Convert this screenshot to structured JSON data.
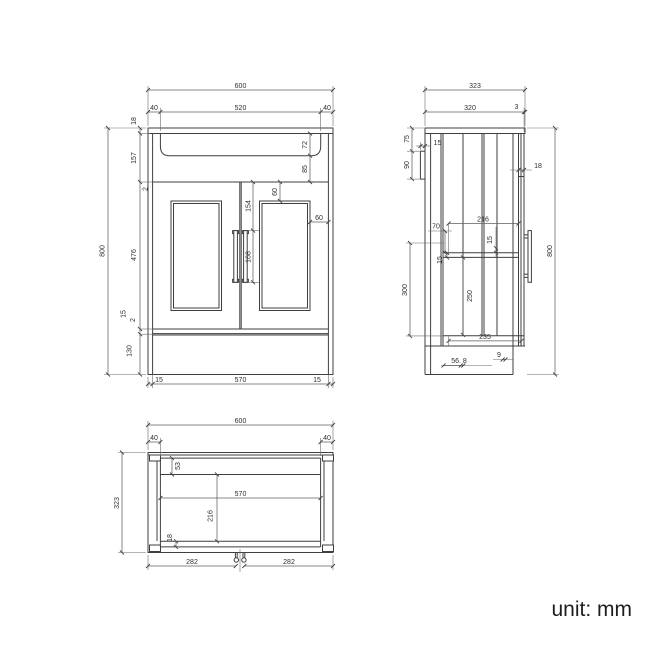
{
  "views": {
    "front": {
      "labels": {
        "overall_width": "600",
        "basin_offset_left": "40",
        "basin_width": "520",
        "basin_offset_right": "40",
        "top_thickness": "18",
        "counter_section": "157",
        "gap_top": "2",
        "door_height": "476",
        "bottom_rail": "15",
        "gap_bottom": "2",
        "plinth_height": "130",
        "overall_height": "800",
        "basin_depth": "72",
        "basin_to_door": "85",
        "panel_top_inset": "60",
        "handle_top_offset": "154",
        "handle_length": "168",
        "panel_side_inset": "60",
        "base_inset_left": "15",
        "base_width": "570",
        "base_inset_right": "15"
      }
    },
    "side": {
      "labels": {
        "overall_depth": "323",
        "counter_depth": "320",
        "back_lip": "3",
        "bracket_top_offset": "75",
        "bracket_height": "90",
        "bracket_width": "15",
        "front_rail": "18",
        "shelf_offset": "70",
        "interior_depth": "216",
        "gap_inner": "15",
        "rail_thickness": "15",
        "compartment_height": "300",
        "interior_height": "250",
        "overall_height": "800",
        "shelf_depth": "235",
        "offset_nine": "9",
        "offset_56_8": "56. 8"
      }
    },
    "plan": {
      "labels": {
        "overall_width": "600",
        "corner_left": "40",
        "corner_right": "40",
        "overall_depth": "323",
        "back_strip": "53",
        "interior_width": "570",
        "interior_depth": "216",
        "front_strip": "18",
        "fixing_left": "282",
        "fixing_right": "282"
      }
    }
  },
  "footer": {
    "unit_label": "unit: mm"
  }
}
